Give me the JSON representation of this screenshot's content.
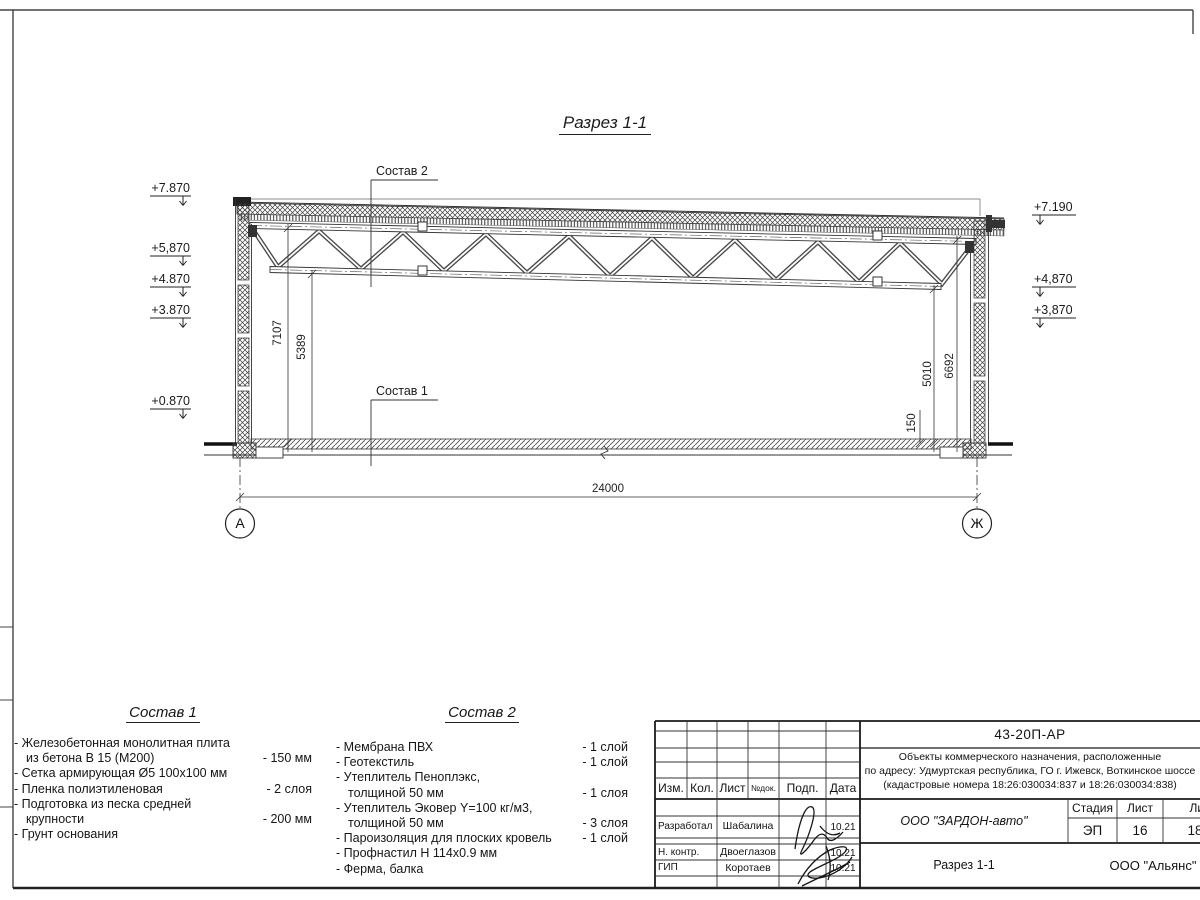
{
  "sheet": {
    "section_title": "Разрез 1-1",
    "callouts": {
      "sostav2": "Состав 2",
      "sostav1": "Состав 1"
    },
    "elevations_left": [
      "+7.870",
      "+5,870",
      "+4.870",
      "+3.870",
      "+0.870"
    ],
    "elevations_right": [
      "+7.190",
      "+4,870",
      "+3,870"
    ],
    "dimensions": {
      "span": "24000",
      "left_h1": "7107",
      "left_h2": "5389",
      "right_h1": "6692",
      "right_h2": "5010",
      "slab_offset": "150"
    },
    "axes": {
      "left": "А",
      "right": "Ж"
    }
  },
  "sostav1": {
    "title": "Состав 1",
    "lines": [
      {
        "l": "- Железобетонная  монолитная плита",
        "r": ""
      },
      {
        "l": "из бетона В 15 (М200)",
        "r": "- 150 мм"
      },
      {
        "l": "- Сетка армирующая Ø5 100х100 мм",
        "r": ""
      },
      {
        "l": "- Пленка полиэтиленовая",
        "r": "- 2 слоя"
      },
      {
        "l": "- Подготовка из песка средней",
        "r": ""
      },
      {
        "l": "крупности",
        "r": "- 200 мм"
      },
      {
        "l": "- Грунт основания",
        "r": ""
      }
    ]
  },
  "sostav2": {
    "title": "Состав 2",
    "lines": [
      {
        "l": "- Мембрана ПВХ",
        "r": "- 1 слой"
      },
      {
        "l": "- Геотекстиль",
        "r": "- 1 слой"
      },
      {
        "l": "- Утеплитель Пеноплэкс,",
        "r": ""
      },
      {
        "l": "толщиной 50 мм",
        "r": "- 1 слоя"
      },
      {
        "l": "- Утеплитель Эковер Y=100 кг/м3,",
        "r": ""
      },
      {
        "l": "толщиной 50 мм",
        "r": "- 3 слоя"
      },
      {
        "l": "- Пароизоляция для плоских кровель",
        "r": "- 1 слой"
      },
      {
        "l": "- Профнастил Н 114х0.9 мм",
        "r": ""
      },
      {
        "l": "- Ферма, балка",
        "r": ""
      }
    ]
  },
  "titleblock": {
    "doc_number": "43-20П-АР",
    "project_line1": "Объекты коммерческого назначения, расположенные",
    "project_line2": "по адресу: Удмуртская республика, ГО г. Ижевск, Воткинское шоссе",
    "project_line3": "(кадастровые номера 18:26:030034:837 и 18:26:030034:838)",
    "headers": {
      "izm": "Изм.",
      "kol": "Кол.",
      "list": "Лист",
      "ndok": "№док.",
      "podp": "Подп.",
      "data": "Дата",
      "stadia": "Стадия",
      "list2": "Лист",
      "listov": "Листов"
    },
    "rows": [
      {
        "role": "Разработал",
        "name": "Шабалина",
        "date": "10.21"
      },
      {
        "role": "Н. контр.",
        "name": "Двоеглазов",
        "date": "10.21"
      },
      {
        "role": "ГИП",
        "name": "Коротаев",
        "date": "10.21"
      }
    ],
    "stadia_value": "ЭП",
    "list_value": "16",
    "listov_value": "18",
    "company": "ООО \"ЗАРДОН-авто\"",
    "sheet_title": "Разрез 1-1",
    "org": "ООО \"Альянс\""
  }
}
